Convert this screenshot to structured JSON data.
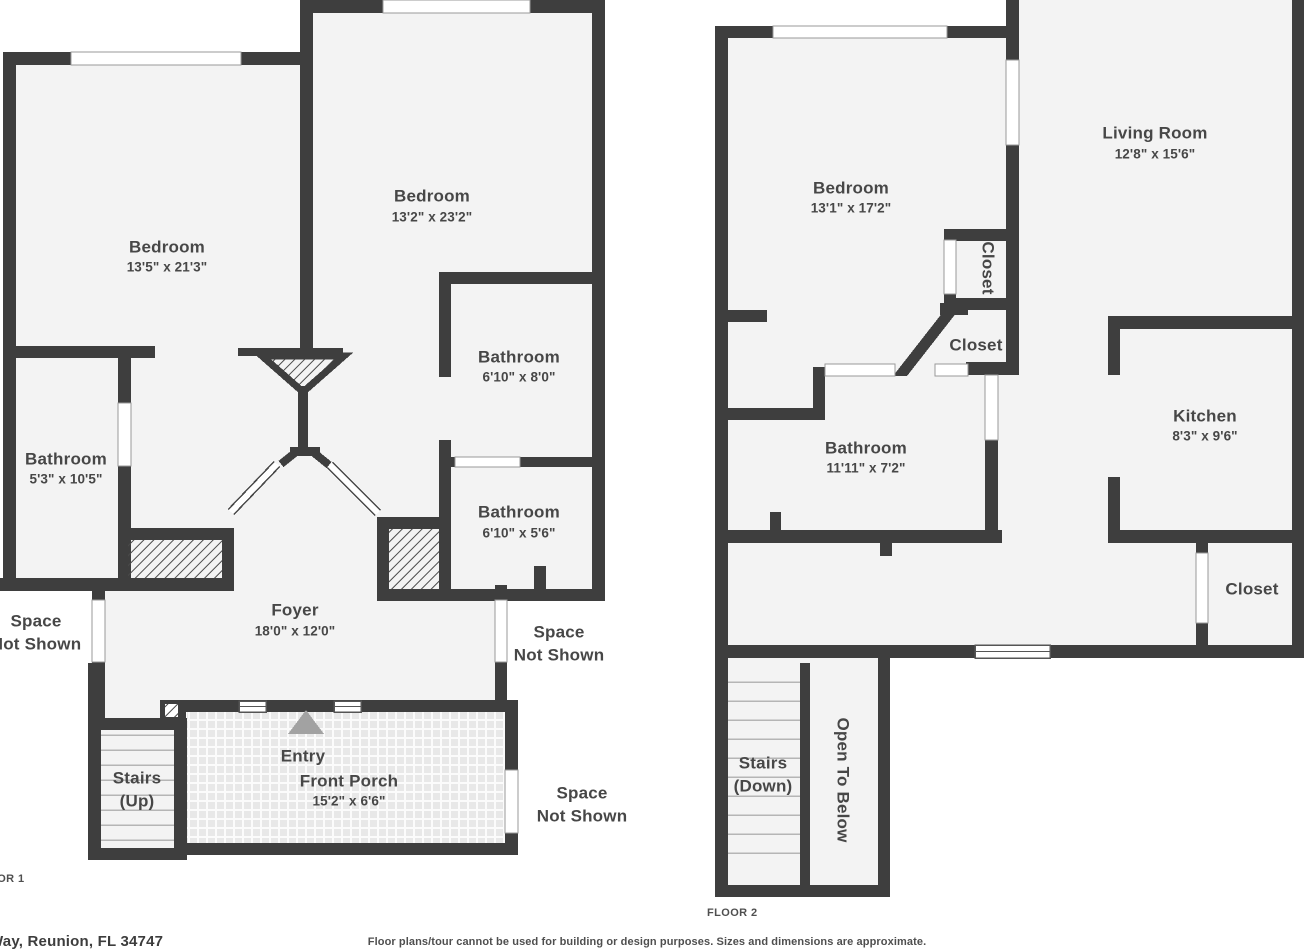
{
  "colors": {
    "wall": "#3e3e3e",
    "floor": "#f3f3f3",
    "text": "#474747",
    "entry_arrow": "#a2a2a2"
  },
  "floor1": {
    "floor_label": "FLOOR 1",
    "rooms": {
      "bedroom_left": {
        "name": "Bedroom",
        "dims": "13'5\" x 21'3\""
      },
      "bedroom_right": {
        "name": "Bedroom",
        "dims": "13'2\" x 23'2\""
      },
      "bathroom_left": {
        "name": "Bathroom",
        "dims": "5'3\" x 10'5\""
      },
      "bathroom_mid": {
        "name": "Bathroom",
        "dims": "6'10\" x 8'0\""
      },
      "bathroom_low": {
        "name": "Bathroom",
        "dims": "6'10\" x 5'6\""
      },
      "foyer": {
        "name": "Foyer",
        "dims": "18'0\" x 12'0\""
      },
      "front_porch": {
        "name": "Front Porch",
        "dims": "15'2\" x 6'6\""
      },
      "entry": {
        "name": "Entry"
      },
      "stairs": {
        "line1": "Stairs",
        "line2": "(Up)"
      }
    },
    "space_not_shown": {
      "line1": "Space",
      "line2": "Not Shown"
    }
  },
  "floor2": {
    "floor_label": "FLOOR 2",
    "rooms": {
      "bedroom": {
        "name": "Bedroom",
        "dims": "13'1\" x 17'2\""
      },
      "living_room": {
        "name": "Living Room",
        "dims": "12'8\" x 15'6\""
      },
      "kitchen": {
        "name": "Kitchen",
        "dims": "8'3\" x 9'6\""
      },
      "bathroom": {
        "name": "Bathroom",
        "dims": "11'11\" x 7'2\""
      },
      "closet_tall": {
        "name": "Closet"
      },
      "closet_mid": {
        "name": "Closet"
      },
      "closet_low": {
        "name": "Closet"
      },
      "stairs": {
        "line1": "Stairs",
        "line2": "(Down)"
      },
      "open_to_below": {
        "name": "Open To Below"
      }
    }
  },
  "footer": {
    "address": "Way, Reunion, FL 34747",
    "disclaimer": "Floor plans/tour cannot be used for building or design purposes. Sizes and dimensions are approximate."
  }
}
